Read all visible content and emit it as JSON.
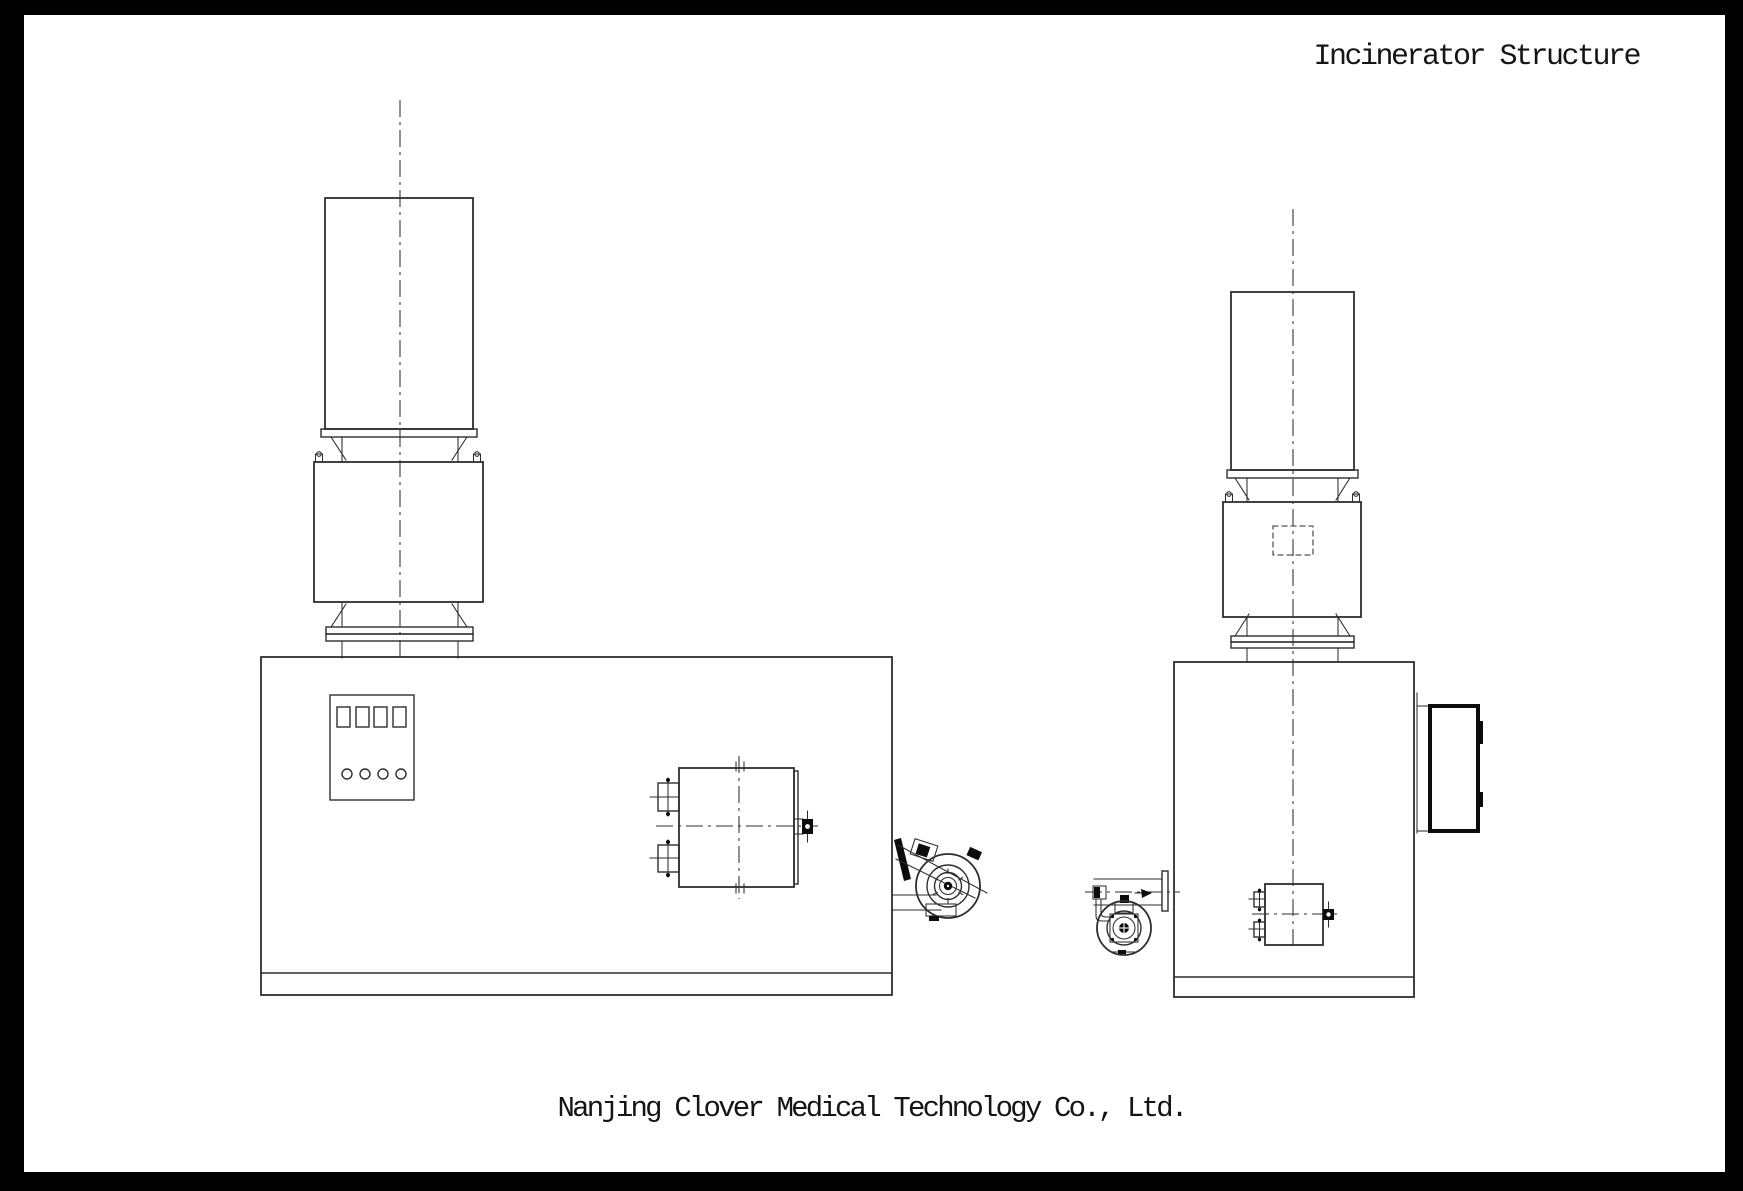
{
  "title": "Incinerator Structure",
  "footer": {
    "company": "Nanjing Clover Medical Technology Co., Ltd."
  },
  "colors": {
    "ink": "#2e2e2e",
    "inkDark": "#0c0c0c",
    "paper": "#ffffff",
    "frame": "#000000"
  }
}
